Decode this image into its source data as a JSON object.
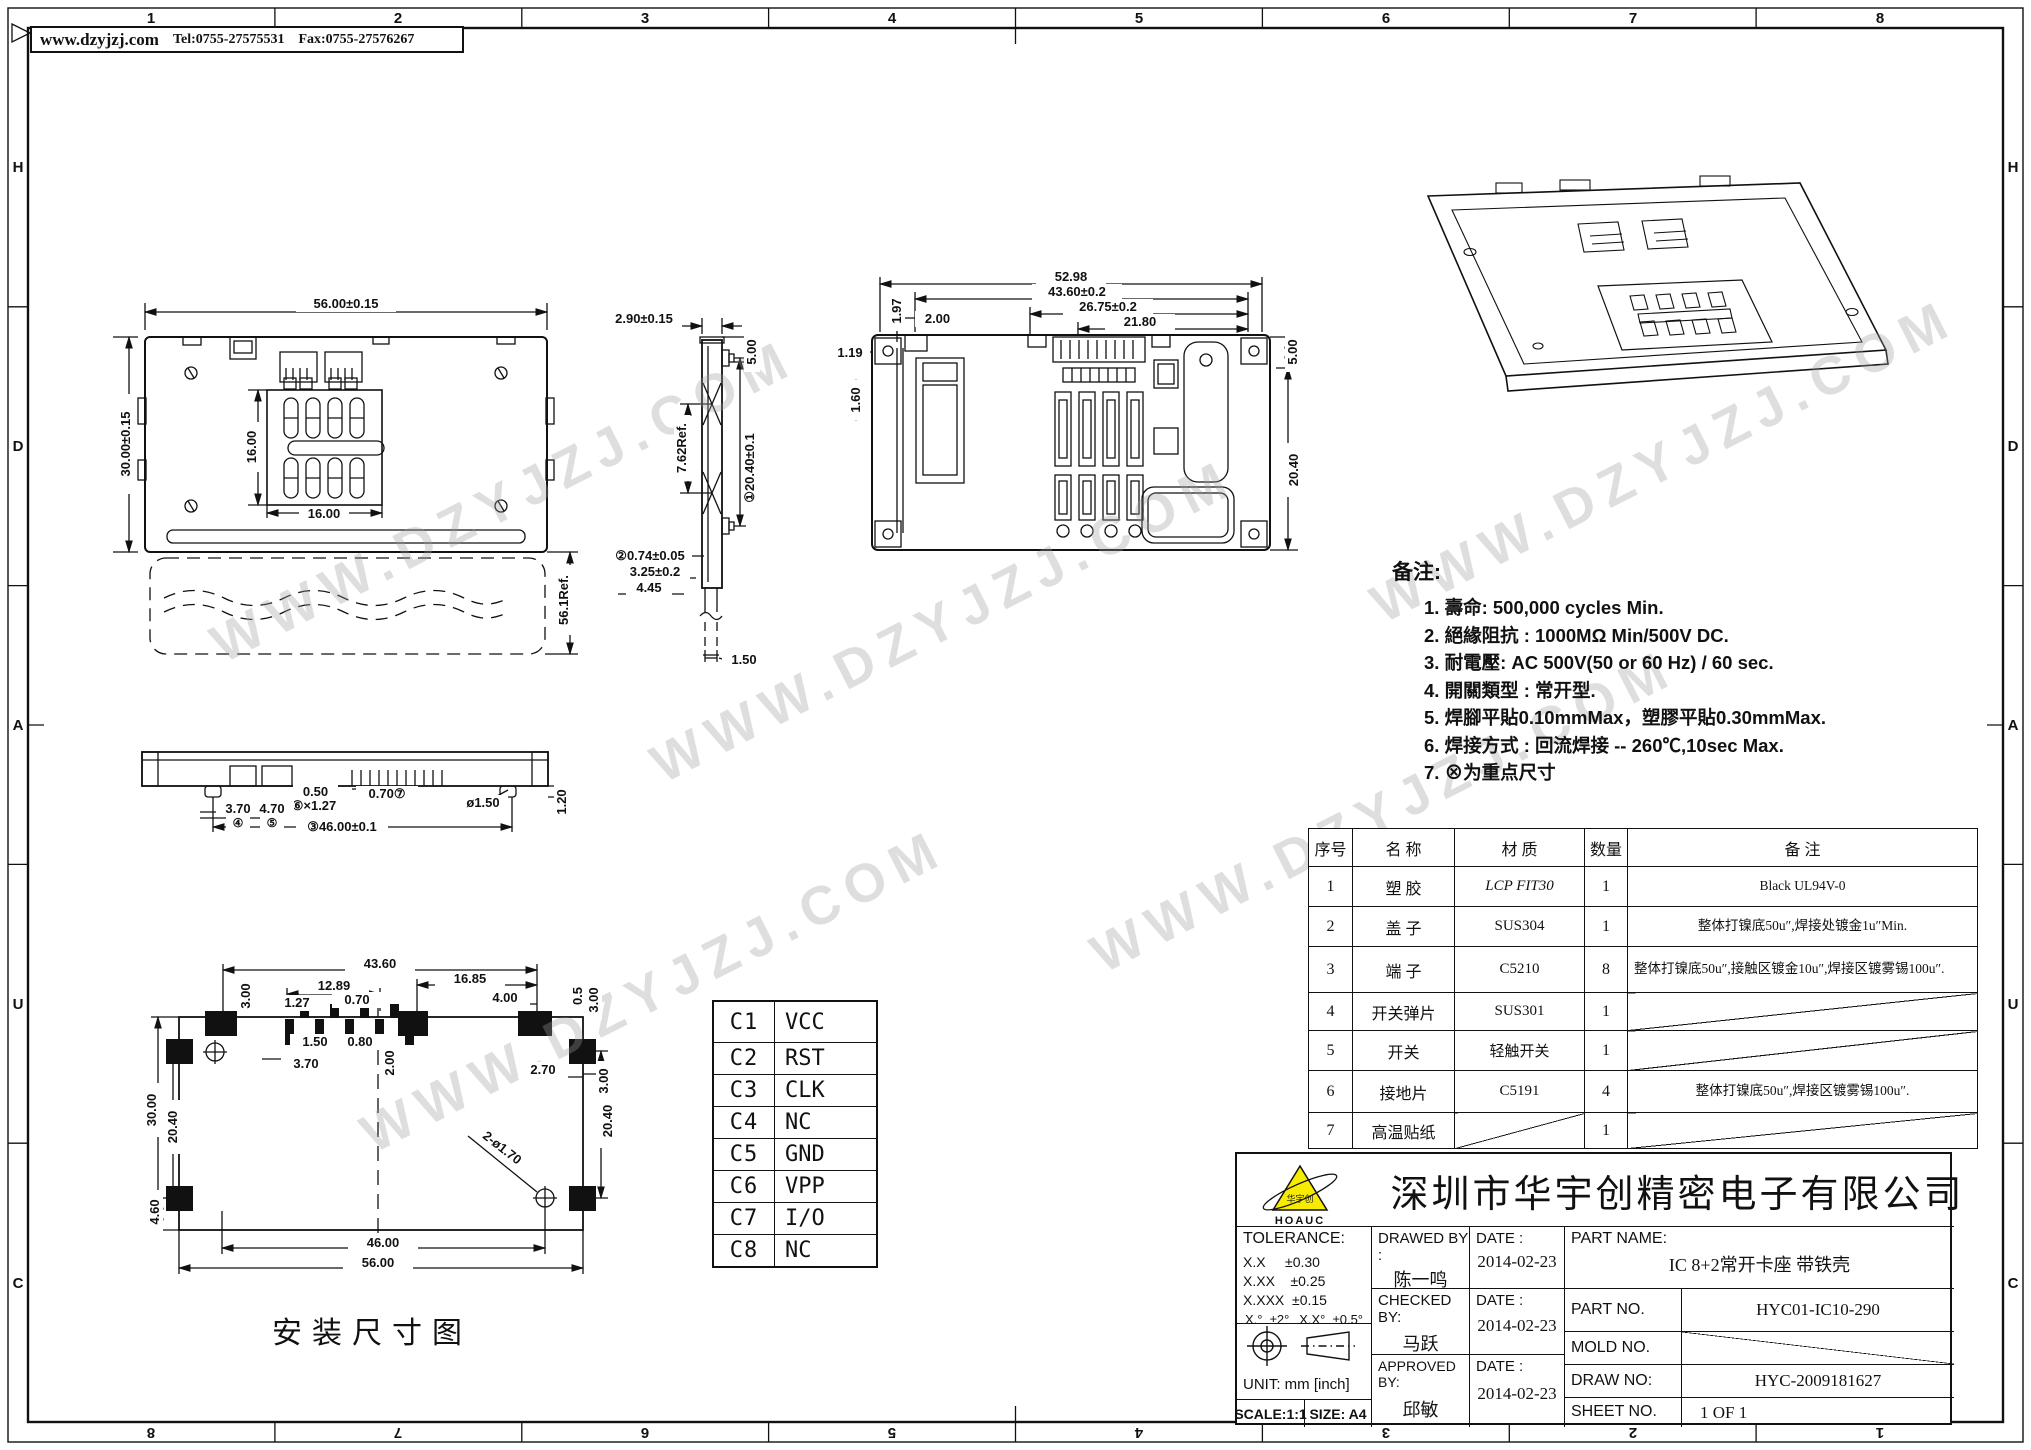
{
  "header": {
    "website": "www.dzyjzj.com",
    "tel": "Tel:0755-27575531",
    "fax": "Fax:0755-27576267"
  },
  "border": {
    "top_numbers": [
      "1",
      "2",
      "3",
      "4",
      "5",
      "6",
      "7",
      "8"
    ],
    "bottom_numbers": [
      "8",
      "7",
      "6",
      "5",
      "4",
      "3",
      "2",
      "1"
    ],
    "left_letters": [
      "H",
      "D",
      "A",
      "U",
      "C"
    ],
    "right_letters": [
      "H",
      "D",
      "A",
      "U",
      "C"
    ]
  },
  "watermark": "WWW.DZYJZJ.COM",
  "views": {
    "top": {
      "w": "56.00±0.15",
      "h": "30.00±0.15",
      "win_h": "16.00",
      "win_w": "16.00",
      "card": "56.1Ref."
    },
    "side": {
      "d1": "2.90±0.15",
      "d2": "5.00",
      "d3": "7.62Ref.",
      "d4": "①20.40±0.1",
      "d5": "②0.74±0.05",
      "d6": "3.25±0.2",
      "d7": "4.45",
      "d8": "1.50"
    },
    "rear": {
      "d1": "52.98",
      "d2": "43.60±0.2",
      "d3": "26.75±0.2",
      "d4": "21.80",
      "d5": "1.97",
      "d6": "2.00",
      "d7": "1.19",
      "d8": "1.60",
      "d9": "5.00",
      "d10": "20.40"
    },
    "front": {
      "d1": "0.50",
      "d2": "0.70⑦",
      "d3": "⑥×1.27",
      "d4": "3.70",
      "d4b": "④",
      "d5": "4.70",
      "d5b": "⑤",
      "d6": "③46.00±0.1",
      "d7": "ø1.50",
      "d8": "1.20"
    },
    "footprint": {
      "d1": "43.60",
      "d2": "16.85",
      "d3": "12.89",
      "d4": "0.70",
      "d5": "1.27",
      "d6": "4.00",
      "d7": "0.5",
      "d8": "3.00",
      "d9": "3.00",
      "d10": "1.50",
      "d11": "0.80",
      "d12": "3.70",
      "d13": "2.00",
      "d14": "2.70",
      "d15": "3.00",
      "d16": "30.00",
      "d17": "20.40",
      "d18": "20.40",
      "d19": "4.60",
      "d20": "2-ø1.70",
      "d21": "46.00",
      "d22": "56.00",
      "caption": "安装尺寸图"
    }
  },
  "pin_table": {
    "rows": [
      [
        "C1",
        "VCC"
      ],
      [
        "C2",
        "RST"
      ],
      [
        "C3",
        "CLK"
      ],
      [
        "C4",
        "NC"
      ],
      [
        "C5",
        "GND"
      ],
      [
        "C6",
        "VPP"
      ],
      [
        "C7",
        "I/O"
      ],
      [
        "C8",
        "NC"
      ]
    ]
  },
  "notes": {
    "title": "备注:",
    "items": [
      "1. 壽命: 500,000 cycles Min.",
      "2. 絕緣阻抗 : 1000MΩ Min/500V DC.",
      "3. 耐電壓: AC 500V(50 or  60 Hz) / 60 sec.",
      "4. 開關類型 : 常开型.",
      "5. 焊腳平貼0.10mmMax，塑膠平貼0.30mmMax.",
      "6. 焊接方式 :  回流焊接  -- 260℃,10sec Max.",
      "7. ⊗为重点尺寸"
    ]
  },
  "parts_table": {
    "headers": [
      "序号",
      "名  称",
      "材  质",
      "数量",
      "备  注"
    ],
    "rows": [
      [
        "1",
        "塑  胶",
        "LCP FIT30",
        "1",
        "Black UL94V-0"
      ],
      [
        "2",
        "盖  子",
        "SUS304",
        "1",
        "整体打镍底50u″,焊接处镀金1u″Min."
      ],
      [
        "3",
        "端  子",
        "C5210",
        "8",
        "整体打镍底50u″,接触区镀金10u″,焊接区镀雾锡100u″."
      ],
      [
        "4",
        "开关弹片",
        "SUS301",
        "1",
        ""
      ],
      [
        "5",
        "开关",
        "轻触开关",
        "1",
        ""
      ],
      [
        "6",
        "接地片",
        "C5191",
        "4",
        "整体打镍底50u″,焊接区镀雾锡100u″."
      ],
      [
        "7",
        "高温贴纸",
        "",
        "1",
        ""
      ]
    ]
  },
  "title_block": {
    "logo_text": "HOAUC",
    "logo_inner": "华宇创",
    "company": "深圳市华宇创精密电子有限公司",
    "tolerance_label": "TOLERANCE:",
    "tol1": "X.X     ±0.30",
    "tol2": "X.XX    ±0.25",
    "tol3": "X.XXX  ±0.15",
    "tol4": "X.°  ±2°",
    "tol5": "X.X°  ±0.5°",
    "drawed_label": "DRAWED BY :",
    "drawed_name": "陈一鸣",
    "checked_label": "CHECKED BY:",
    "checked_name": "马跃",
    "approved_label": "APPROVED BY:",
    "approved_name": "邱敏",
    "date_label": "DATE :",
    "date1": "2014-02-23",
    "date2": "2014-02-23",
    "date3": "2014-02-23",
    "part_name_label": "PART NAME:",
    "part_name": "IC 8+2常开卡座  带铁壳",
    "part_no_label": "PART NO.",
    "part_no": "HYC01-IC10-290",
    "mold_no_label": "MOLD NO.",
    "draw_no_label": "DRAW NO:",
    "draw_no": "HYC-2009181627",
    "sheet_no_label": "SHEET NO.",
    "sheet_no": "1 OF 1",
    "unit_label": "UNIT:  mm [inch]",
    "scale_label": "SCALE:1:1",
    "size_label": "SIZE:  A4"
  }
}
